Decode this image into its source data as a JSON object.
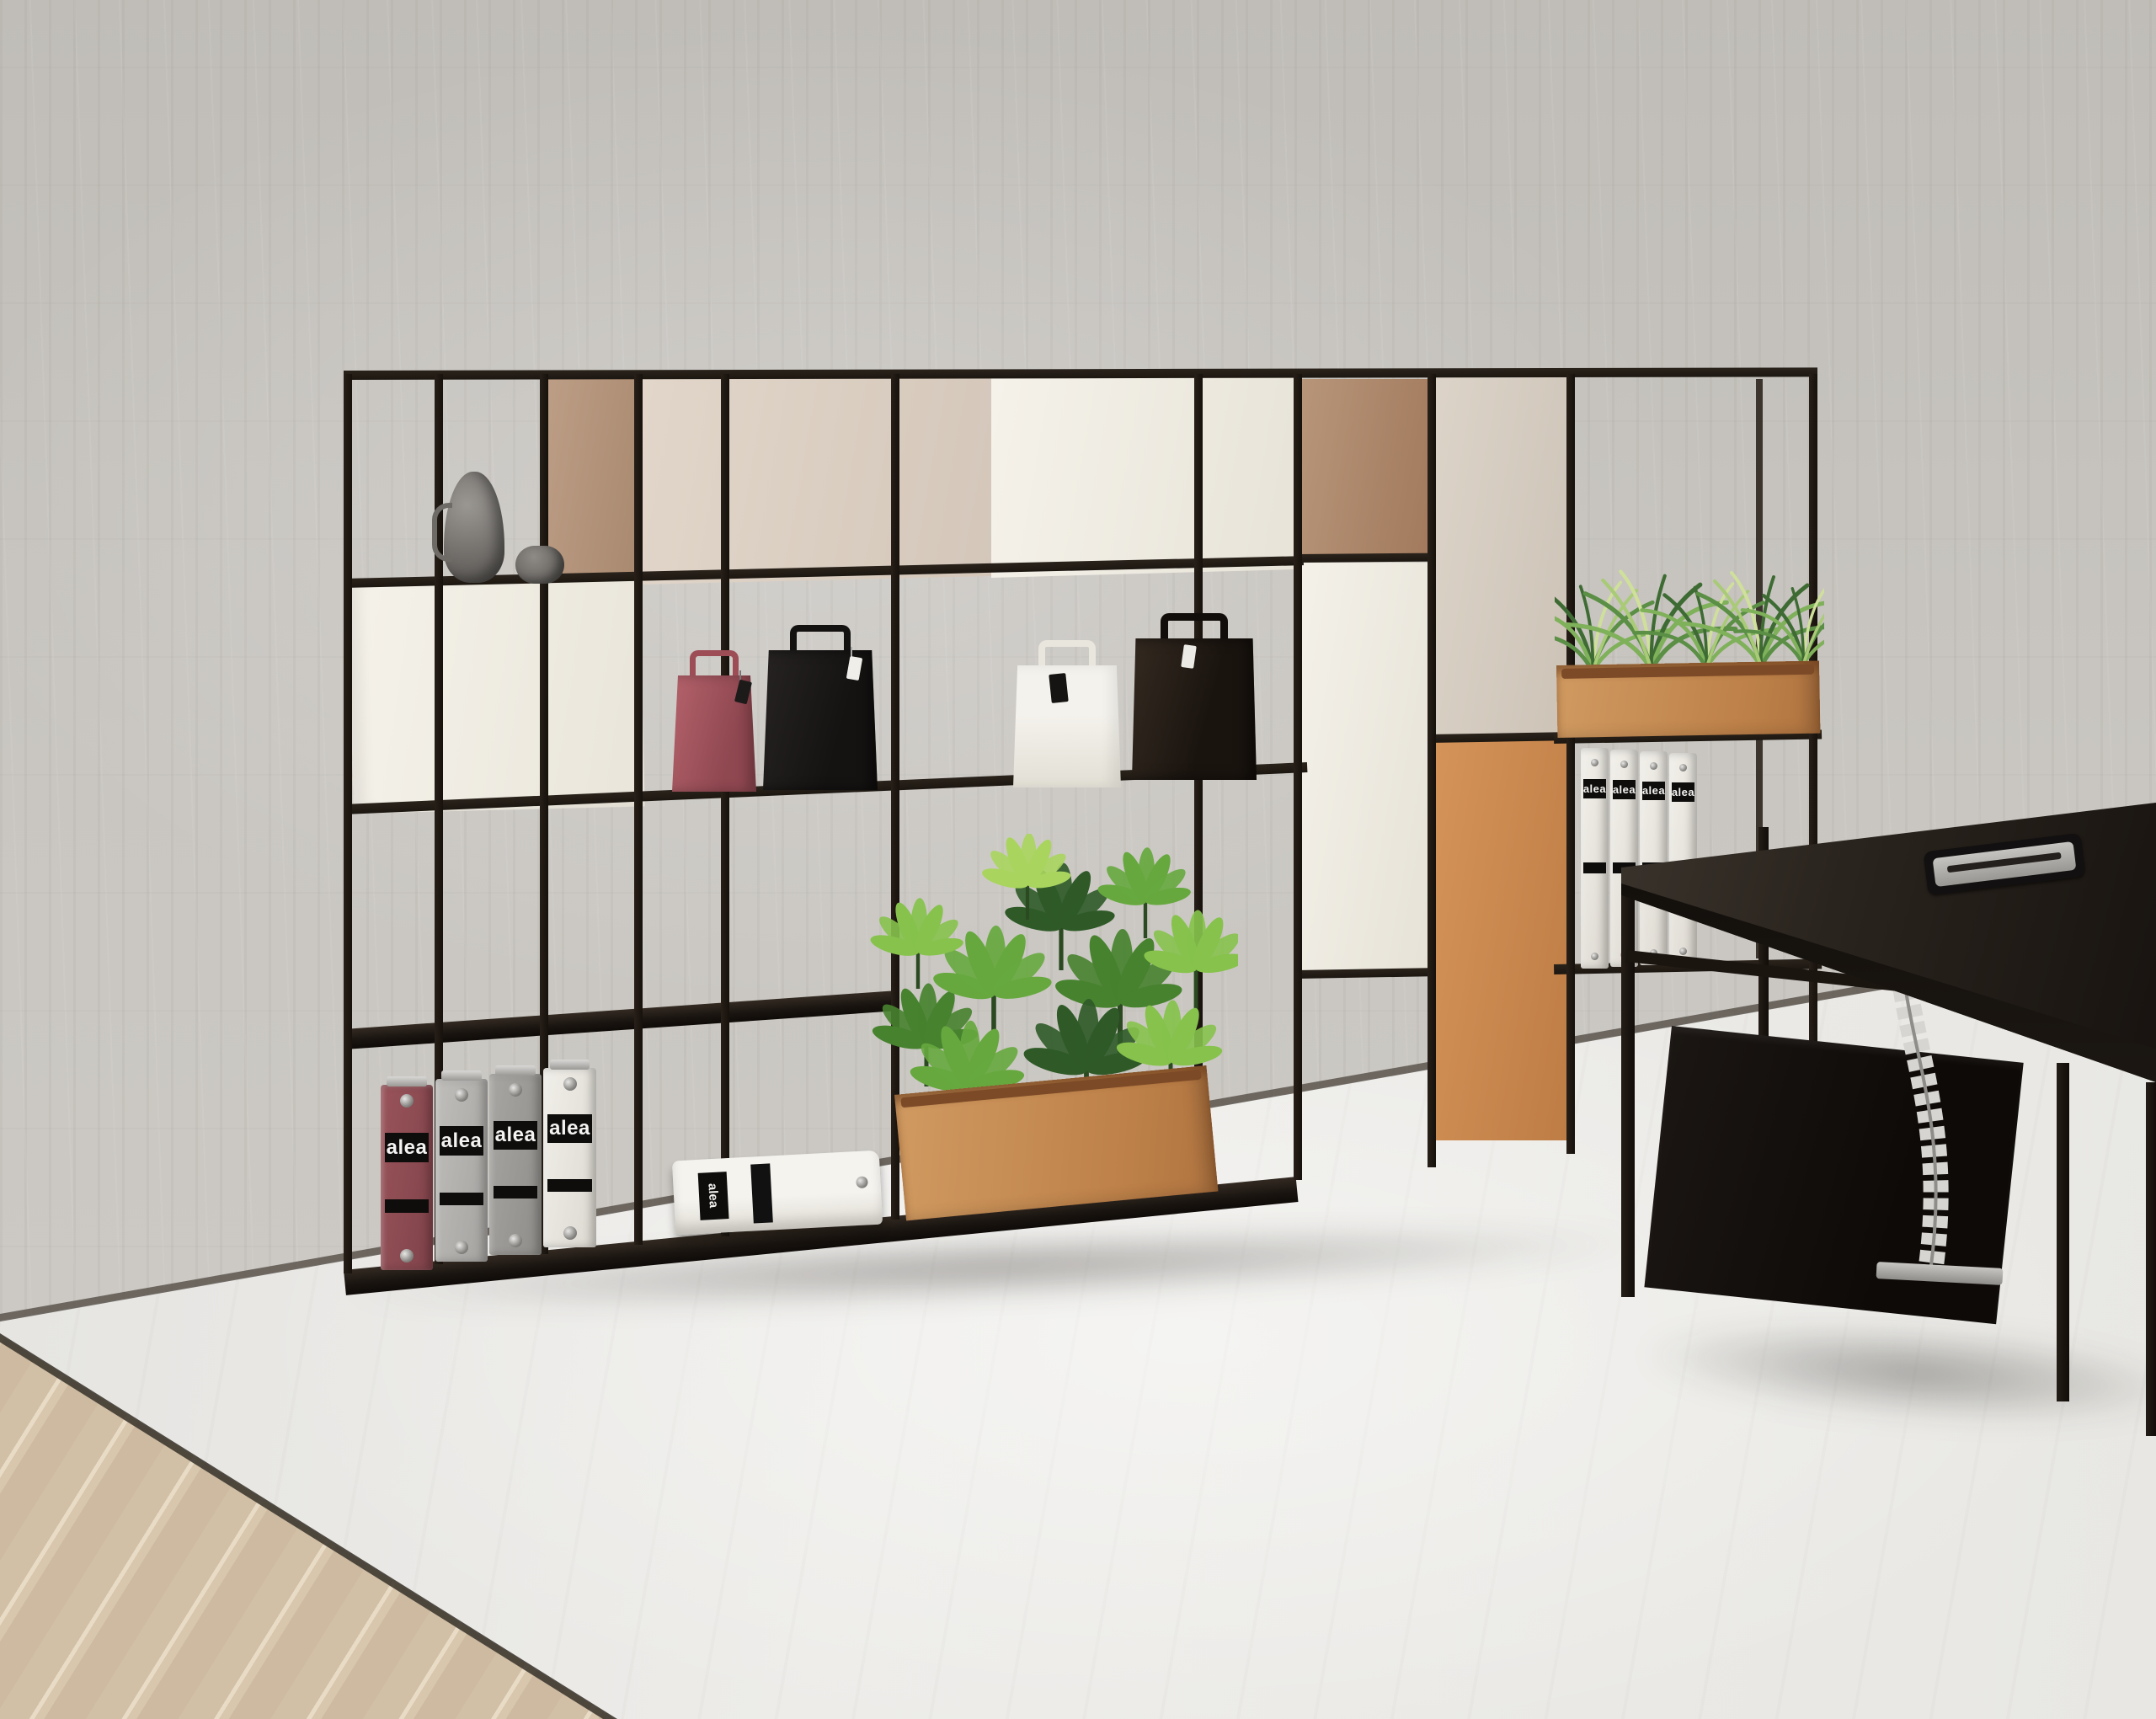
{
  "scene": {
    "description": "Office interior render: modular black-frame shelving unit with cabinets, binders, paper bags and plants against a concrete wall, dark executive desk at right, light concrete floor with wood planks at lower left",
    "binder_label": "alea",
    "wall_color": "#c7c4bf",
    "floor_color": "#e9e8e4",
    "wood_floor_color": "#d2c0a6",
    "shelving": {
      "frame_color": "#211a14",
      "panel_colors": {
        "tan_back_panel": "#b5967e",
        "beige_door": "#ddd1c5",
        "white_door": "#f2efe7",
        "white_tall_cabinet": "#f3f0e8",
        "beige_tall_cabinet": "#d9d0c5",
        "orange_cabinet": "#cb8b52"
      }
    },
    "objects": {
      "vases": [
        {
          "name": "pewter-pitcher",
          "color": "#7b7874"
        },
        {
          "name": "pewter-bowl",
          "color": "#6f6c68"
        }
      ],
      "left_binders": [
        {
          "color": "#8d4a4f"
        },
        {
          "color": "#b7b5b2"
        },
        {
          "color": "#a09e9a"
        },
        {
          "color": "#edebe6"
        }
      ],
      "right_binders_count": 4,
      "lying_binder_color": "#efede8",
      "bags": [
        {
          "name": "red-paper-bag",
          "color": "#a9565e",
          "tag_color": "#1d1b1a"
        },
        {
          "name": "black-paper-bag",
          "color": "#1d1b1a",
          "tag_color": "#f0eee9"
        },
        {
          "name": "white-paper-bag",
          "color": "#f0ede5",
          "tag_color": "#161412"
        },
        {
          "name": "brown-leather-bag",
          "color": "#261f19",
          "tag_color": "#f0eee9"
        }
      ],
      "plants": [
        {
          "name": "schefflera-planter",
          "trough_color": "#c28a55",
          "foliage_colors": [
            "#2f5a28",
            "#47822f",
            "#66a83e",
            "#86c24c",
            "#a9d55e"
          ]
        },
        {
          "name": "spider-plant-planter",
          "trough_color": "#c28a55",
          "foliage_colors": [
            "#3e6b33",
            "#5a8f45",
            "#7fb05a",
            "#cfe09a"
          ]
        }
      ],
      "desk": {
        "top_color": "#2a241e",
        "frame_color": "#1b1510",
        "cabinet_color": "#141010",
        "cable_spine_color": "#d6d5d2"
      }
    }
  }
}
